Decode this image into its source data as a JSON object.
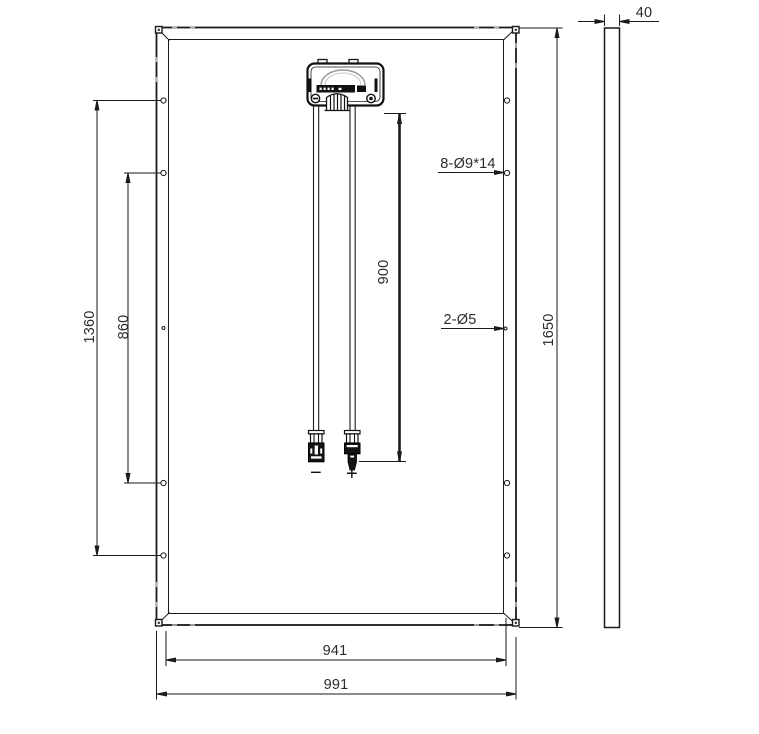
{
  "labels": {
    "hole_span_outer": "1360",
    "hole_span_inner": "860",
    "cable_length": "900",
    "panel_height": "1650",
    "inner_width": "941",
    "panel_width": "991",
    "frame_thickness": "40",
    "mounting_holes": "8-Ø9*14",
    "grounding_holes": "2-Ø5",
    "negative_terminal": "−",
    "positive_terminal": "+"
  },
  "colors": {
    "line": "#1a1a1a",
    "dimension_text": "#2b2b2b",
    "drain_tick": "#b3b3b3"
  }
}
